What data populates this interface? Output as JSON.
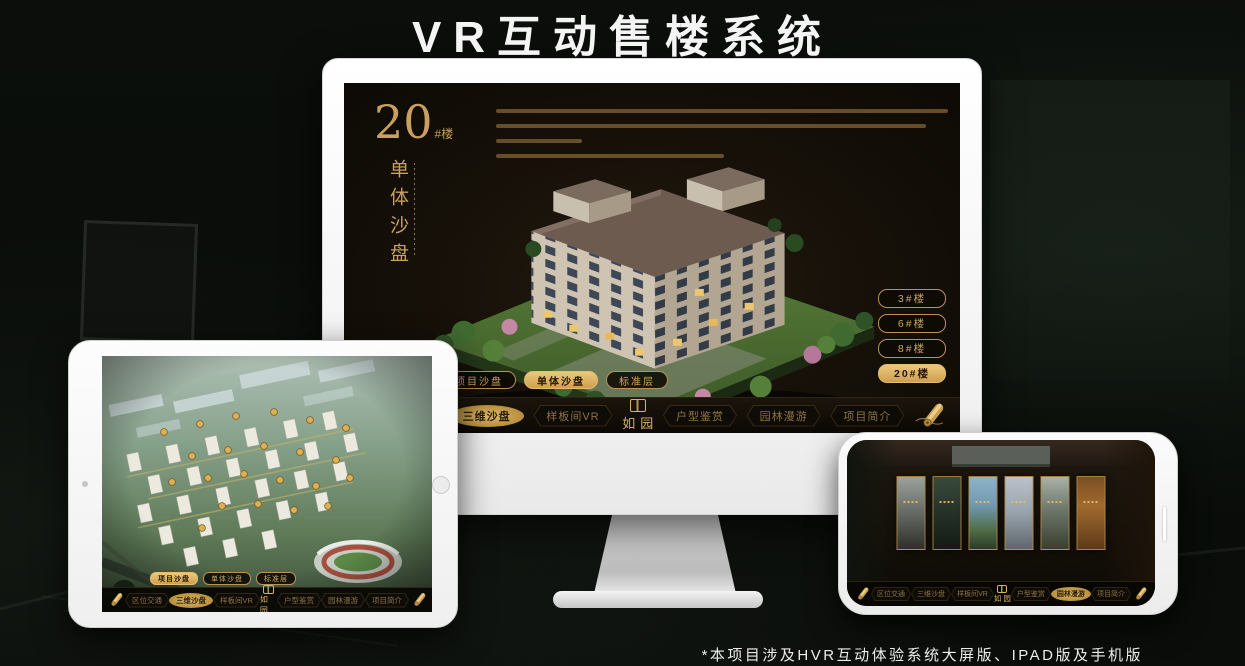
{
  "title": "VR互动售楼系统",
  "footnote": "*本项目涉及HVR互动体验系统大屏版、IPAD版及手机版",
  "colors": {
    "accent_gold": "#C9A05F",
    "active_gold_bg": "#DDB26A",
    "screen_bg": "#15100A",
    "title_text": "#F4F4F4"
  },
  "icons": {
    "nav_end": "scroll-icon",
    "logo_mark": "seal-icon"
  },
  "monitor_ui": {
    "headline": {
      "number": "20",
      "unit": "#楼",
      "subtitle_vertical": "单体沙盘"
    },
    "building_buttons": [
      {
        "label": "3#楼",
        "active": false
      },
      {
        "label": "6#楼",
        "active": false
      },
      {
        "label": "8#楼",
        "active": false
      },
      {
        "label": "20#楼",
        "active": true
      }
    ],
    "sub_tabs": [
      {
        "label": "项目沙盘",
        "active": false
      },
      {
        "label": "单体沙盘",
        "active": true
      },
      {
        "label": "标准层",
        "active": false
      }
    ],
    "nav": {
      "logo": "如园",
      "items": [
        {
          "label": "区位交通",
          "active": false
        },
        {
          "label": "三维沙盘",
          "active": true
        },
        {
          "label": "样板间VR",
          "active": false
        },
        {
          "label": "户型鉴赏",
          "active": false
        },
        {
          "label": "园林漫游",
          "active": false
        },
        {
          "label": "项目简介",
          "active": false
        }
      ]
    }
  },
  "tablet_ui": {
    "sub_tabs": [
      {
        "label": "项目沙盘",
        "active": true
      },
      {
        "label": "单体沙盘",
        "active": false
      },
      {
        "label": "标准层",
        "active": false
      }
    ],
    "nav": {
      "logo": "如园",
      "items": [
        {
          "label": "区位交通",
          "active": false
        },
        {
          "label": "三维沙盘",
          "active": true
        },
        {
          "label": "样板间VR",
          "active": false
        },
        {
          "label": "户型鉴赏",
          "active": false
        },
        {
          "label": "园林漫游",
          "active": false
        },
        {
          "label": "项目简介",
          "active": false
        }
      ]
    }
  },
  "phone_ui": {
    "nav": {
      "logo": "如园",
      "items": [
        {
          "label": "区位交通",
          "active": false
        },
        {
          "label": "三维沙盘",
          "active": false
        },
        {
          "label": "样板间VR",
          "active": false
        },
        {
          "label": "户型鉴赏",
          "active": false
        },
        {
          "label": "园林漫游",
          "active": true
        },
        {
          "label": "项目简介",
          "active": false
        }
      ]
    }
  }
}
